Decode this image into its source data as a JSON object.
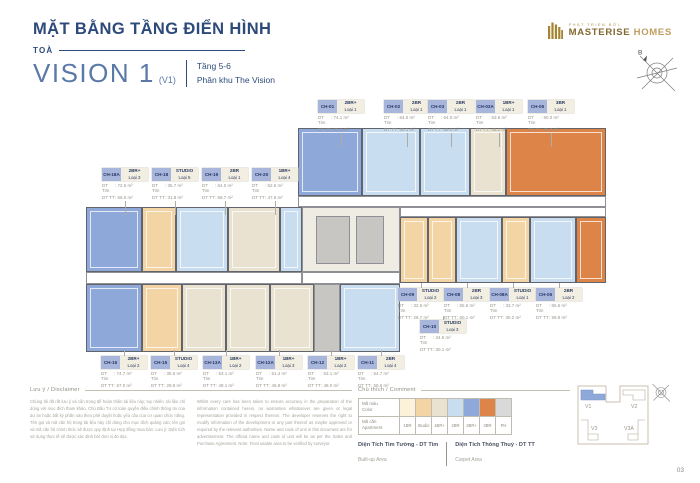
{
  "header": {
    "title": "MẶT BẰNG TẦNG ĐIỂN HÌNH",
    "tower_label": "TOÀ",
    "tower_name": "VISION 1",
    "tower_code": "(V1)",
    "floor_range": "Tầng 5-6",
    "zone": "Phân khu The Vision"
  },
  "logo": {
    "tagline": "PHÁT TRIỂN BỞI",
    "brand_primary": "MASTERISE",
    "brand_secondary": "HOMES"
  },
  "compass": {
    "label": "B"
  },
  "area_labels": {
    "tim": "DT Tim",
    "tt": "DT TT"
  },
  "callouts": [
    {
      "code": "CH-01",
      "type": "2BR+",
      "loai": "Loại 1",
      "tim": "74.1 m²",
      "tt": "67.1 m²",
      "x": 318,
      "y": 100,
      "dir": "down",
      "llen": 14
    },
    {
      "code": "CH-02",
      "type": "2BR",
      "loai": "Loại 1",
      "tim": "64.0 m²",
      "tt": "59.1 m²",
      "x": 384,
      "y": 100,
      "dir": "down",
      "llen": 14
    },
    {
      "code": "CH-03",
      "type": "2BR",
      "loai": "Loại 1",
      "tim": "64.0 m²",
      "tt": "59.0 m²",
      "x": 428,
      "y": 100,
      "dir": "down",
      "llen": 14
    },
    {
      "code": "CH-03A",
      "type": "1BR+",
      "loai": "Loại 1",
      "tim": "53.5 m²",
      "tt": "48.2 m²",
      "x": 476,
      "y": 100,
      "dir": "down",
      "llen": 14
    },
    {
      "code": "CH-05",
      "type": "3BR",
      "loai": "Loại 1",
      "tim": "90.0 m²",
      "tt": "85.7 m²",
      "x": 528,
      "y": 100,
      "dir": "down",
      "llen": 14
    },
    {
      "code": "CH-18A",
      "type": "2BR+",
      "loai": "Loại 3",
      "tim": "72.5 m²",
      "tt": "66.5 m²",
      "x": 102,
      "y": 168,
      "dir": "down",
      "llen": 14
    },
    {
      "code": "CH-18",
      "type": "STUDIO",
      "loai": "Loại 5",
      "tim": "35.7 m²",
      "tt": "31.8 m²",
      "x": 152,
      "y": 168,
      "dir": "down",
      "llen": 14
    },
    {
      "code": "CH-19",
      "type": "2BR",
      "loai": "Loại 1",
      "tim": "64.0 m²",
      "tt": "58.7 m²",
      "x": 202,
      "y": 168,
      "dir": "down",
      "llen": 14
    },
    {
      "code": "CH-20",
      "type": "1BR+",
      "loai": "Loại 4",
      "tim": "52.6 m²",
      "tt": "47.6 m²",
      "x": 252,
      "y": 168,
      "dir": "down",
      "llen": 14
    },
    {
      "code": "CH-16",
      "type": "2BR+",
      "loai": "Loại 2",
      "tim": "74.7 m²",
      "tt": "67.0 m²",
      "x": 101,
      "y": 356,
      "dir": "up",
      "llen": 6
    },
    {
      "code": "CH-15",
      "type": "STUDIO",
      "loai": "Loại 4",
      "tim": "35.5 m²",
      "tt": "29.8 m²",
      "x": 151,
      "y": 356,
      "dir": "up",
      "llen": 6
    },
    {
      "code": "CH-13A",
      "type": "1BR+",
      "loai": "Loại 2",
      "tim": "53.1 m²",
      "tt": "48.1 m²",
      "x": 203,
      "y": 356,
      "dir": "up",
      "llen": 6
    },
    {
      "code": "CH-12A",
      "type": "1BR+",
      "loai": "Loại 3",
      "tim": "51.4 m²",
      "tt": "46.9 m²",
      "x": 256,
      "y": 356,
      "dir": "up",
      "llen": 6
    },
    {
      "code": "CH-12",
      "type": "1BR+",
      "loai": "Loại 2",
      "tim": "53.1 m²",
      "tt": "48.0 m²",
      "x": 308,
      "y": 356,
      "dir": "up",
      "llen": 6
    },
    {
      "code": "CH-11",
      "type": "2BR",
      "loai": "Loại 4",
      "tim": "64.7 m²",
      "tt": "59.6 m²",
      "x": 358,
      "y": 356,
      "dir": "up",
      "llen": 6
    },
    {
      "code": "CH-09",
      "type": "STUDIO",
      "loai": "Loại 2",
      "tim": "32.6 m²",
      "tt": "28.7 m²",
      "x": 398,
      "y": 288,
      "dir": "up",
      "llen": 5
    },
    {
      "code": "CH-08",
      "type": "2BR",
      "loai": "Loại 3",
      "tim": "65.6 m²",
      "tt": "60.1 m²",
      "x": 444,
      "y": 288,
      "dir": "up",
      "llen": 5
    },
    {
      "code": "CH-08A",
      "type": "STUDIO",
      "loai": "Loại 1",
      "tim": "33.7 m²",
      "tt": "30.2 m²",
      "x": 490,
      "y": 288,
      "dir": "up",
      "llen": 5
    },
    {
      "code": "CH-06",
      "type": "2BR",
      "loai": "Loại 2",
      "tim": "65.6 m²",
      "tt": "59.8 m²",
      "x": 536,
      "y": 288,
      "dir": "up",
      "llen": 5
    },
    {
      "code": "CH-10",
      "type": "STUDIO",
      "loai": "Loại 3",
      "tim": "34.5 m²",
      "tt": "30.1 m²",
      "x": 420,
      "y": 320,
      "dir": "up",
      "llen": 4
    }
  ],
  "plan": {
    "palette": {
      "br2p": "#8ea8d9",
      "br2": "#c9ddf1",
      "br1p": "#e9e2d1",
      "br1": "#fbf2d9",
      "stu": "#f3d4a5",
      "br3": "#dd8449",
      "cor": "#ffffff",
      "core": "#c7c6c2",
      "coreL": "#efece4"
    },
    "blocks": [
      {
        "x": 298,
        "y": 128,
        "w": 64,
        "h": 68,
        "c": "br2p"
      },
      {
        "x": 362,
        "y": 128,
        "w": 58,
        "h": 68,
        "c": "br2"
      },
      {
        "x": 420,
        "y": 128,
        "w": 50,
        "h": 68,
        "c": "br2"
      },
      {
        "x": 470,
        "y": 128,
        "w": 36,
        "h": 68,
        "c": "br1p"
      },
      {
        "x": 506,
        "y": 128,
        "w": 100,
        "h": 68,
        "c": "br3"
      },
      {
        "x": 298,
        "y": 196,
        "w": 308,
        "h": 11,
        "c": "cor"
      },
      {
        "x": 86,
        "y": 207,
        "w": 56,
        "h": 65,
        "c": "br2p"
      },
      {
        "x": 142,
        "y": 207,
        "w": 34,
        "h": 65,
        "c": "stu"
      },
      {
        "x": 176,
        "y": 207,
        "w": 52,
        "h": 65,
        "c": "br2"
      },
      {
        "x": 228,
        "y": 207,
        "w": 52,
        "h": 65,
        "c": "br1p"
      },
      {
        "x": 280,
        "y": 207,
        "w": 22,
        "h": 65,
        "c": "br2"
      },
      {
        "x": 86,
        "y": 272,
        "w": 216,
        "h": 12,
        "c": "cor"
      },
      {
        "x": 302,
        "y": 207,
        "w": 98,
        "h": 65,
        "c": "coreL"
      },
      {
        "x": 316,
        "y": 216,
        "w": 34,
        "h": 48,
        "c": "core"
      },
      {
        "x": 356,
        "y": 216,
        "w": 28,
        "h": 48,
        "c": "core"
      },
      {
        "x": 302,
        "y": 272,
        "w": 98,
        "h": 12,
        "c": "cor"
      },
      {
        "x": 86,
        "y": 284,
        "w": 56,
        "h": 68,
        "c": "br2p"
      },
      {
        "x": 142,
        "y": 284,
        "w": 40,
        "h": 68,
        "c": "stu"
      },
      {
        "x": 182,
        "y": 284,
        "w": 44,
        "h": 68,
        "c": "br1p"
      },
      {
        "x": 226,
        "y": 284,
        "w": 44,
        "h": 68,
        "c": "br1p"
      },
      {
        "x": 270,
        "y": 284,
        "w": 44,
        "h": 68,
        "c": "br1p"
      },
      {
        "x": 314,
        "y": 284,
        "w": 26,
        "h": 68,
        "c": "core"
      },
      {
        "x": 340,
        "y": 284,
        "w": 60,
        "h": 68,
        "c": "br2"
      },
      {
        "x": 400,
        "y": 207,
        "w": 206,
        "h": 10,
        "c": "cor"
      },
      {
        "x": 400,
        "y": 217,
        "w": 28,
        "h": 66,
        "c": "stu"
      },
      {
        "x": 428,
        "y": 217,
        "w": 28,
        "h": 66,
        "c": "stu"
      },
      {
        "x": 456,
        "y": 217,
        "w": 46,
        "h": 66,
        "c": "br2"
      },
      {
        "x": 502,
        "y": 217,
        "w": 28,
        "h": 66,
        "c": "stu"
      },
      {
        "x": 530,
        "y": 217,
        "w": 46,
        "h": 66,
        "c": "br2"
      },
      {
        "x": 576,
        "y": 217,
        "w": 30,
        "h": 66,
        "c": "br3"
      }
    ]
  },
  "legend": {
    "heading": "Chú thích / Comment",
    "color_row": {
      "vi": "Mã màu",
      "en": "Color"
    },
    "apt_row": {
      "vi": "Mã căn",
      "en": "Apartment"
    },
    "columns": [
      {
        "label": "1BR",
        "color": "#fbf2d9"
      },
      {
        "label": "Studio",
        "color": "#f3d4a5"
      },
      {
        "label": "1BR+",
        "color": "#e9e2d1"
      },
      {
        "label": "2BR",
        "color": "#c9ddf1"
      },
      {
        "label": "2BR+",
        "color": "#8ea8d9"
      },
      {
        "label": "3BR",
        "color": "#dd8449"
      },
      {
        "label": "PH",
        "color": "#d9d9d9"
      }
    ],
    "notes": [
      {
        "vi": "Diện Tích Tim Tường - DT Tim",
        "en": "Built-up Area"
      },
      {
        "vi": "Diện Tích Thông Thuỷ - DT TT",
        "en": "Carpet Area"
      }
    ]
  },
  "disclaimer": {
    "heading": "Lưu ý / Disclaimer",
    "vi": "Chúng tôi đã rất lưu ý và cẩn trọng để hoàn thiện tài liệu này; tuy nhiên, tài liệu chỉ dùng với mục đích tham khảo. Chủ Đầu Tư có toàn quyền điều chỉnh thông tin của dự án hoặc bất kỳ phần nào theo phê duyệt hoặc yêu cầu của cơ quan chức năng. Tên gọi và mã căn hộ trong tài liệu này chỉ dùng cho mục đích quảng cáo; tên gọi và mã căn hộ chính thức sẽ được quy định tại Hợp đồng mua bán. Lưu ý: Diện tích sử dụng thực tế sẽ được xác định bởi đơn vị đo đạc.",
    "en": "Whilst every care has been taken to ensure accuracy in the preparation of the information contained herein, no warranties whatsoever are given or legal representation provided in respect thereon. The developer reserves the right to modify information of the development or any part thereof as maybe approved or required by the relevant authorities. Name and code of unit in this document are for advertisement. The official name and code of unit will be as per the Sales and Purchase Agreement. Note: Final usable area to be verified by surveyor."
  },
  "keyplan": {
    "labels": [
      "V1",
      "V2",
      "V3",
      "V3A"
    ],
    "active": "V1"
  },
  "page_number": "03"
}
